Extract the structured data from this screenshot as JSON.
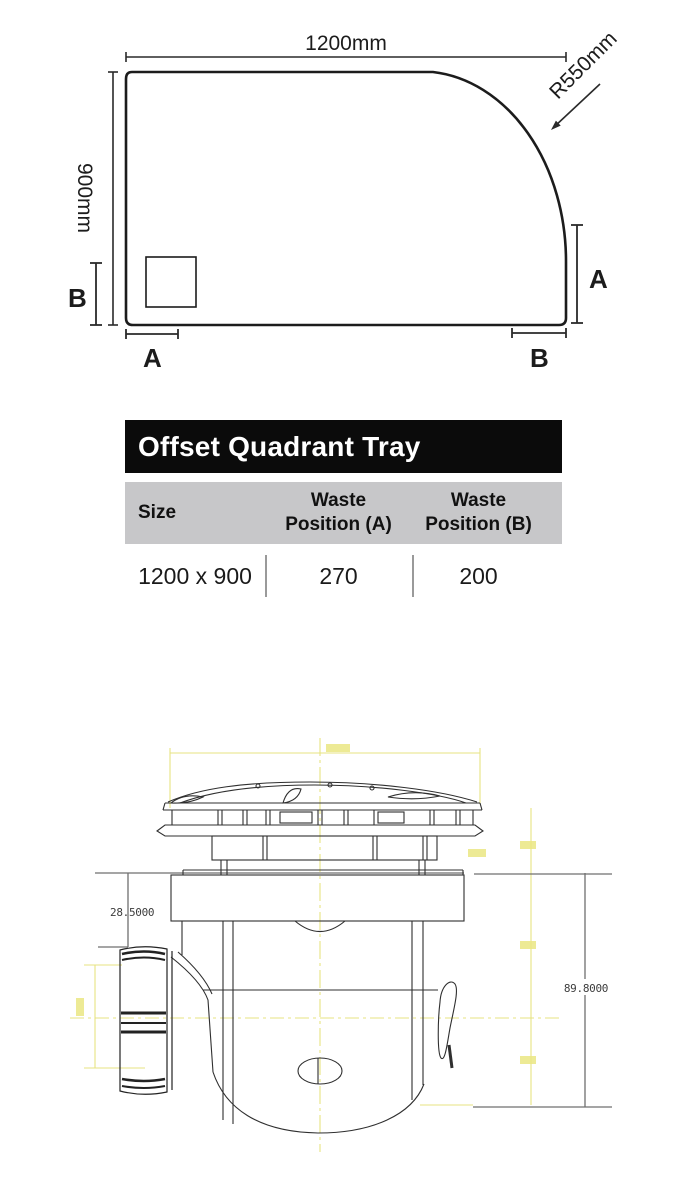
{
  "tray_diagram": {
    "width_label": "1200mm",
    "height_label": "900mm",
    "radius_label": "R550mm",
    "marker_a": "A",
    "marker_b": "B"
  },
  "spec_table": {
    "title": "Offset Quadrant Tray",
    "columns": {
      "size": "Size",
      "waste_a_line1": "Waste",
      "waste_a_line2": "Position (A)",
      "waste_b_line1": "Waste",
      "waste_b_line2": "Position (B)"
    },
    "row": {
      "size": "1200 x 900",
      "waste_a": "270",
      "waste_b": "200"
    },
    "colors": {
      "title_bg": "#0b0b0b",
      "title_text": "#ffffff",
      "header_bg": "#c7c7c9",
      "divider": "#9a9a9a"
    }
  },
  "trap_drawing": {
    "dim_flange_height": "28.5000",
    "dim_total_height": "89.8000",
    "colors": {
      "cad_yellow": "#e6e27c",
      "line_dark": "#2f2f2f",
      "line_gray": "#777777"
    }
  }
}
